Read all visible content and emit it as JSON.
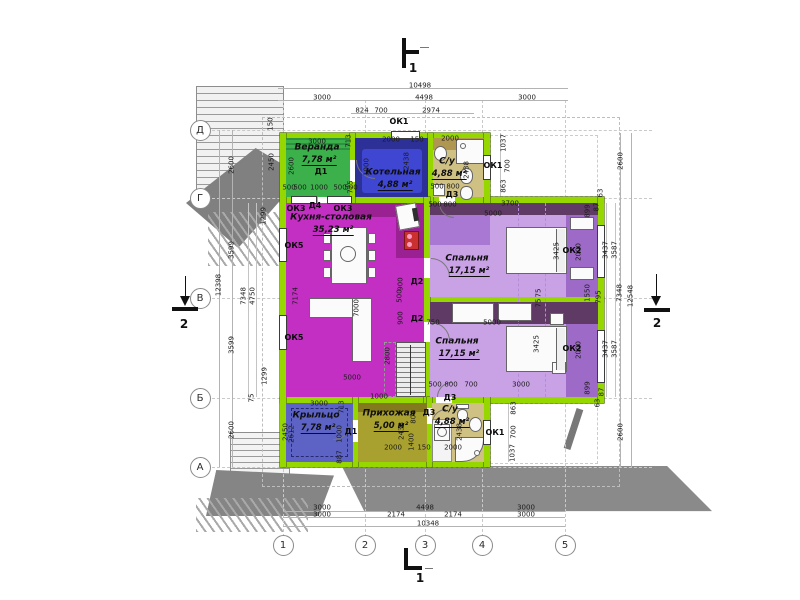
{
  "drawing_type": "floor-plan",
  "axes": {
    "left": [
      "Д",
      "Г",
      "В",
      "Б",
      "А"
    ],
    "bottom": [
      "1",
      "2",
      "3",
      "4",
      "5"
    ]
  },
  "section_markers": [
    {
      "label": "1",
      "pos": "top"
    },
    {
      "label": "1",
      "pos": "bottom"
    },
    {
      "label": "2",
      "pos": "left"
    },
    {
      "label": "2",
      "pos": "right"
    }
  ],
  "rooms": [
    {
      "id": "veranda",
      "name": "Веранда",
      "area": "7,78 м²",
      "x": 317,
      "y": 148
    },
    {
      "id": "boiler",
      "name": "Котельная",
      "area": "4,88 м²",
      "x": 393,
      "y": 173
    },
    {
      "id": "bath-top",
      "name": "С/у",
      "area": "4,88 м²",
      "x": 447,
      "y": 162
    },
    {
      "id": "kitchen",
      "name": "Кухня-столовая",
      "area": "35,23 м²",
      "x": 331,
      "y": 218
    },
    {
      "id": "bedroom-1",
      "name": "Спальня",
      "area": "17,15 м²",
      "x": 467,
      "y": 259
    },
    {
      "id": "bedroom-2",
      "name": "Спальня",
      "area": "17,15 м²",
      "x": 457,
      "y": 342
    },
    {
      "id": "porch",
      "name": "Крыльцо",
      "area": "7,78 м²",
      "x": 316,
      "y": 416
    },
    {
      "id": "hallway",
      "name": "Прихожая",
      "area": "5,00 м²",
      "x": 389,
      "y": 414
    },
    {
      "id": "bath-bottom",
      "name": "С/у",
      "area": "4,88 м²",
      "x": 450,
      "y": 410
    }
  ],
  "openings": [
    {
      "label": "ОК1",
      "x": 399,
      "y": 122
    },
    {
      "label": "Д1",
      "x": 321,
      "y": 172
    },
    {
      "label": "Д3",
      "x": 452,
      "y": 195
    },
    {
      "label": "ОК1",
      "x": 493,
      "y": 166
    },
    {
      "label": "ОК3",
      "x": 296,
      "y": 209
    },
    {
      "label": "Д4",
      "x": 315,
      "y": 206
    },
    {
      "label": "ОК3",
      "x": 343,
      "y": 209
    },
    {
      "label": "ОК5",
      "x": 294,
      "y": 246
    },
    {
      "label": "ОК5",
      "x": 294,
      "y": 338
    },
    {
      "label": "Д2",
      "x": 417,
      "y": 282
    },
    {
      "label": "Д2",
      "x": 417,
      "y": 319
    },
    {
      "label": "ОК2",
      "x": 572,
      "y": 251
    },
    {
      "label": "ОК2",
      "x": 572,
      "y": 349
    },
    {
      "label": "Д1",
      "x": 351,
      "y": 432
    },
    {
      "label": "Д3",
      "x": 450,
      "y": 398
    },
    {
      "label": "Д3",
      "x": 429,
      "y": 413
    },
    {
      "label": "ОК1",
      "x": 495,
      "y": 433
    }
  ],
  "dims": [
    {
      "t": "10498",
      "x": 420,
      "y": 86
    },
    {
      "t": "3000",
      "x": 322,
      "y": 98
    },
    {
      "t": "4498",
      "x": 424,
      "y": 98
    },
    {
      "t": "3000",
      "x": 527,
      "y": 98
    },
    {
      "t": "824",
      "x": 362,
      "y": 111
    },
    {
      "t": "700",
      "x": 381,
      "y": 111
    },
    {
      "t": "2974",
      "x": 431,
      "y": 111
    },
    {
      "t": "3000",
      "x": 317,
      "y": 142
    },
    {
      "t": "2600",
      "x": 292,
      "y": 166,
      "v": 1
    },
    {
      "t": "500",
      "x": 289,
      "y": 188
    },
    {
      "t": "500",
      "x": 300,
      "y": 188
    },
    {
      "t": "1000",
      "x": 319,
      "y": 188
    },
    {
      "t": "500",
      "x": 340,
      "y": 188
    },
    {
      "t": "500",
      "x": 351,
      "y": 188
    },
    {
      "t": "2000",
      "x": 391,
      "y": 140
    },
    {
      "t": "150",
      "x": 417,
      "y": 140
    },
    {
      "t": "713",
      "x": 349,
      "y": 141,
      "v": 1
    },
    {
      "t": "1000",
      "x": 367,
      "y": 167,
      "v": 1
    },
    {
      "t": "725",
      "x": 351,
      "y": 187,
      "v": 1
    },
    {
      "t": "2438",
      "x": 407,
      "y": 161,
      "v": 1
    },
    {
      "t": "2000",
      "x": 450,
      "y": 139
    },
    {
      "t": "2438",
      "x": 467,
      "y": 170,
      "v": 1
    },
    {
      "t": "500",
      "x": 437,
      "y": 187
    },
    {
      "t": "800",
      "x": 453,
      "y": 187
    },
    {
      "t": "1037",
      "x": 504,
      "y": 143,
      "v": 1
    },
    {
      "t": "700",
      "x": 508,
      "y": 166,
      "v": 1
    },
    {
      "t": "863",
      "x": 504,
      "y": 186,
      "v": 1
    },
    {
      "t": "2600",
      "x": 621,
      "y": 161,
      "v": 1
    },
    {
      "t": "5000",
      "x": 352,
      "y": 378
    },
    {
      "t": "7174",
      "x": 296,
      "y": 296,
      "v": 1
    },
    {
      "t": "7000",
      "x": 357,
      "y": 308,
      "v": 1
    },
    {
      "t": "2800",
      "x": 388,
      "y": 356,
      "v": 1
    },
    {
      "t": "900",
      "x": 401,
      "y": 284,
      "v": 1
    },
    {
      "t": "500",
      "x": 400,
      "y": 296,
      "v": 1
    },
    {
      "t": "900",
      "x": 401,
      "y": 318,
      "v": 1
    },
    {
      "t": "1000",
      "x": 379,
      "y": 397
    },
    {
      "t": "500",
      "x": 435,
      "y": 205
    },
    {
      "t": "800",
      "x": 450,
      "y": 205
    },
    {
      "t": "3700",
      "x": 510,
      "y": 204
    },
    {
      "t": "5000",
      "x": 493,
      "y": 214
    },
    {
      "t": "3425",
      "x": 557,
      "y": 251,
      "v": 1
    },
    {
      "t": "75",
      "x": 539,
      "y": 293,
      "v": 1
    },
    {
      "t": "75",
      "x": 539,
      "y": 303,
      "v": 1
    },
    {
      "t": "899",
      "x": 588,
      "y": 211,
      "v": 1
    },
    {
      "t": "63",
      "x": 601,
      "y": 193,
      "v": 1
    },
    {
      "t": "87",
      "x": 597,
      "y": 207,
      "v": 1
    },
    {
      "t": "2000",
      "x": 579,
      "y": 252,
      "v": 1
    },
    {
      "t": "3437",
      "x": 606,
      "y": 250,
      "v": 1
    },
    {
      "t": "3587",
      "x": 615,
      "y": 250,
      "v": 1
    },
    {
      "t": "1550",
      "x": 588,
      "y": 293,
      "v": 1
    },
    {
      "t": "795",
      "x": 599,
      "y": 297,
      "v": 1
    },
    {
      "t": "750",
      "x": 433,
      "y": 323
    },
    {
      "t": "5000",
      "x": 492,
      "y": 323
    },
    {
      "t": "3425",
      "x": 537,
      "y": 344,
      "v": 1
    },
    {
      "t": "500",
      "x": 435,
      "y": 385
    },
    {
      "t": "800",
      "x": 451,
      "y": 385
    },
    {
      "t": "700",
      "x": 471,
      "y": 385
    },
    {
      "t": "3000",
      "x": 521,
      "y": 385
    },
    {
      "t": "2000",
      "x": 579,
      "y": 350,
      "v": 1
    },
    {
      "t": "3437",
      "x": 606,
      "y": 349,
      "v": 1
    },
    {
      "t": "3587",
      "x": 615,
      "y": 349,
      "v": 1
    },
    {
      "t": "899",
      "x": 588,
      "y": 388,
      "v": 1
    },
    {
      "t": "87",
      "x": 602,
      "y": 392,
      "v": 1
    },
    {
      "t": "63",
      "x": 598,
      "y": 403,
      "v": 1
    },
    {
      "t": "2600",
      "x": 621,
      "y": 432,
      "v": 1
    },
    {
      "t": "3000",
      "x": 319,
      "y": 404
    },
    {
      "t": "713",
      "x": 342,
      "y": 407,
      "v": 1
    },
    {
      "t": "1000",
      "x": 340,
      "y": 434,
      "v": 1
    },
    {
      "t": "887",
      "x": 340,
      "y": 457,
      "v": 1
    },
    {
      "t": "2450",
      "x": 286,
      "y": 432,
      "v": 1
    },
    {
      "t": "2612",
      "x": 292,
      "y": 434,
      "v": 1
    },
    {
      "t": "2000",
      "x": 393,
      "y": 448
    },
    {
      "t": "1400",
      "x": 412,
      "y": 442,
      "v": 1
    },
    {
      "t": "2438",
      "x": 402,
      "y": 431,
      "v": 1
    },
    {
      "t": "800",
      "x": 414,
      "y": 417,
      "v": 1
    },
    {
      "t": "150",
      "x": 424,
      "y": 448
    },
    {
      "t": "2000",
      "x": 453,
      "y": 448
    },
    {
      "t": "2438",
      "x": 460,
      "y": 432,
      "v": 1
    },
    {
      "t": "863",
      "x": 514,
      "y": 408,
      "v": 1
    },
    {
      "t": "700",
      "x": 514,
      "y": 432,
      "v": 1
    },
    {
      "t": "1037",
      "x": 513,
      "y": 453,
      "v": 1
    },
    {
      "t": "3000",
      "x": 322,
      "y": 508
    },
    {
      "t": "4498",
      "x": 425,
      "y": 508
    },
    {
      "t": "3000",
      "x": 526,
      "y": 508
    },
    {
      "t": "3000",
      "x": 322,
      "y": 515
    },
    {
      "t": "2174",
      "x": 396,
      "y": 515
    },
    {
      "t": "2174",
      "x": 453,
      "y": 515
    },
    {
      "t": "3000",
      "x": 526,
      "y": 515
    },
    {
      "t": "10348",
      "x": 428,
      "y": 524
    },
    {
      "t": "150",
      "x": 271,
      "y": 124,
      "v": 1
    },
    {
      "t": "2450",
      "x": 272,
      "y": 162,
      "v": 1
    },
    {
      "t": "2600",
      "x": 232,
      "y": 165,
      "v": 1
    },
    {
      "t": "1299",
      "x": 264,
      "y": 216,
      "v": 1
    },
    {
      "t": "3599",
      "x": 232,
      "y": 250,
      "v": 1
    },
    {
      "t": "7348",
      "x": 244,
      "y": 296,
      "v": 1
    },
    {
      "t": "4750",
      "x": 253,
      "y": 296,
      "v": 1
    },
    {
      "t": "12398",
      "x": 219,
      "y": 285,
      "v": 1
    },
    {
      "t": "1299",
      "x": 265,
      "y": 376,
      "v": 1
    },
    {
      "t": "3599",
      "x": 232,
      "y": 345,
      "v": 1
    },
    {
      "t": "75",
      "x": 252,
      "y": 398,
      "v": 1
    },
    {
      "t": "2600",
      "x": 232,
      "y": 430,
      "v": 1
    },
    {
      "t": "7348",
      "x": 620,
      "y": 293,
      "v": 1
    },
    {
      "t": "12548",
      "x": 631,
      "y": 296,
      "v": 1
    }
  ]
}
